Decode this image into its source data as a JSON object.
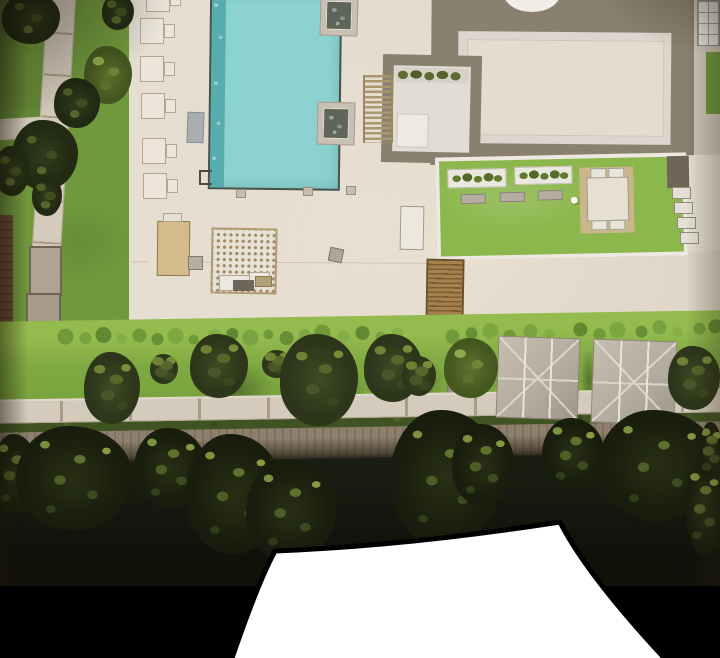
{
  "meta": {
    "domain": "Natural-Image",
    "description": "Webtoon panel: photographed aerial scale model of a riverside residential amenity deck, ending in a black gutter with a white flash-transition shape."
  },
  "scene": {
    "pool_area": {
      "pool": "rectangular swimming pool, cyan water, mosaic edge on left",
      "jacuzzi_count": 2,
      "lounge_chair_count": 6,
      "deck": "cream stone pool deck"
    },
    "building": {
      "roof": "large flat roof with taupe walkway band",
      "rooftop_circle": "white circular skylight at top edge",
      "courtyard": "sunken atrium with planting row",
      "pergola": "slatted timber pergola beside atrium"
    },
    "roof_terrace": {
      "planter_count": 2,
      "bench_count": 3,
      "dining_set": "square table with 4 chairs on tan mat",
      "lamp": "white sphere lamp"
    },
    "plaza": {
      "long_table": "communal dining table with chairs",
      "trellis": "lattice-roof pergola with seating",
      "boardwalk": "timber deck ramp",
      "misc": "stone cube stool, white lounger mat"
    },
    "lawn": {
      "bush_row_count": 32,
      "canopy_count": 2,
      "large_tree_count": 6,
      "objects": "stone boulder, small table"
    },
    "waterfront": {
      "promenade": "paved riverside path with joints",
      "hedge": "clipped hedge strip",
      "embankment": "stone revetment wall",
      "water": "dark river",
      "tree_cluster_count": 11
    },
    "left_garden": {
      "path": "diagonal garden path",
      "fence": "brown timber fence",
      "stone_blocks": 2
    },
    "panel": {
      "gutter": "black panel gutter",
      "transition_shape": "white flash transition wedge"
    }
  },
  "palette": {
    "deck": "#e9e3d9",
    "pool": "#8dd9da",
    "pool-edge": "#55b0b6",
    "pool-line": "#45514a",
    "lawn": "#6f9c3f",
    "lawn-strip": "#7fae45",
    "lawn-light": "#95c050",
    "terrace-green": "#8cbc4e",
    "band": "#8b8274",
    "roof": "#e2ddd5",
    "roof-inner": "#e8e3db",
    "path": "#d8d1c5",
    "path-joint": "#ac9f8c",
    "hedge": "#3d5423",
    "embank": "#8f8271",
    "embank-dark": "#4e4639",
    "water": "#131a12",
    "water-deep": "#0a0e0a",
    "canopy": "#b8b1a7",
    "canopy-light": "#c9c3b9",
    "seam": "#edebe6",
    "tan": "#d8c08f",
    "wood": "#9a7a4a",
    "fence": "#6a4a34",
    "stone": "#b2a899",
    "chair": "#f1ede6",
    "chair-edge": "#b5aa9a",
    "frame-white": "#f3f1ec",
    "bench": "#b7b2a8",
    "jacuzzi": "#5d665c",
    "jacuzzi-frame": "#cdc6bb",
    "white": "#ffffff",
    "black": "#000000"
  }
}
